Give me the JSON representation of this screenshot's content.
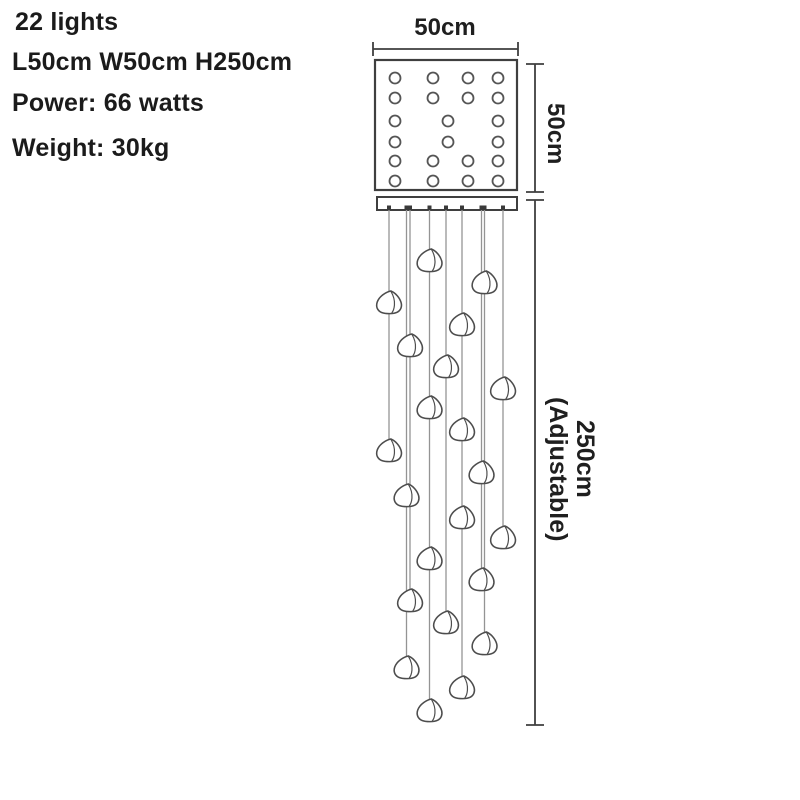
{
  "specs": [
    "22 lights",
    "L50cm W50cm H250cm",
    "Power: 66 watts",
    "Weight: 30kg"
  ],
  "dimensions": {
    "top_width_label": "50cm",
    "side_height_label": "50cm",
    "drop_length_label": "250cm",
    "drop_note_label": "(Adjustable)"
  },
  "colors": {
    "text": "#1b1b1b",
    "outline": "#3f3f3f",
    "hole_stroke": "#555555",
    "cable": "#949494",
    "crystal_stroke": "#4d4d4d",
    "crystal_fill": "#ffffff"
  },
  "diagram": {
    "plate": {
      "x": 375,
      "y": 60,
      "w": 142,
      "h": 130,
      "hole_radius": 5.5,
      "hole_rows": [
        {
          "y": 78,
          "xs": [
            395,
            433,
            468,
            498
          ]
        },
        {
          "y": 98,
          "xs": [
            395,
            433,
            468,
            498
          ]
        },
        {
          "y": 121,
          "xs": [
            395,
            448,
            498
          ]
        },
        {
          "y": 142,
          "xs": [
            395,
            448,
            498
          ]
        },
        {
          "y": 161,
          "xs": [
            395,
            433,
            468,
            498
          ]
        },
        {
          "y": 181,
          "xs": [
            395,
            433,
            468,
            498
          ]
        }
      ]
    },
    "bar": {
      "x": 377,
      "y": 197,
      "w": 140,
      "h": 13
    },
    "width_dim": {
      "y": 49,
      "x1": 373,
      "x2": 518,
      "tick": 7
    },
    "height_dim": {
      "x": 535,
      "y1": 64,
      "y2": 192,
      "cap": 9
    },
    "drop_dim": {
      "x": 535,
      "y1": 200,
      "y2": 725,
      "cap": 9
    },
    "strings": [
      {
        "x": 389,
        "crystals": [
          302,
          450
        ]
      },
      {
        "x": 406.5,
        "crystals": [
          495,
          667
        ]
      },
      {
        "x": 410,
        "crystals": [
          345,
          600
        ]
      },
      {
        "x": 429.5,
        "crystals": [
          260,
          407,
          558,
          710
        ]
      },
      {
        "x": 446,
        "crystals": [
          366,
          622
        ]
      },
      {
        "x": 462,
        "crystals": [
          324,
          429,
          517,
          687
        ]
      },
      {
        "x": 481.5,
        "crystals": [
          472,
          579
        ]
      },
      {
        "x": 484.5,
        "crystals": [
          282,
          643
        ]
      },
      {
        "x": 503,
        "crystals": [
          388,
          537
        ]
      }
    ]
  }
}
